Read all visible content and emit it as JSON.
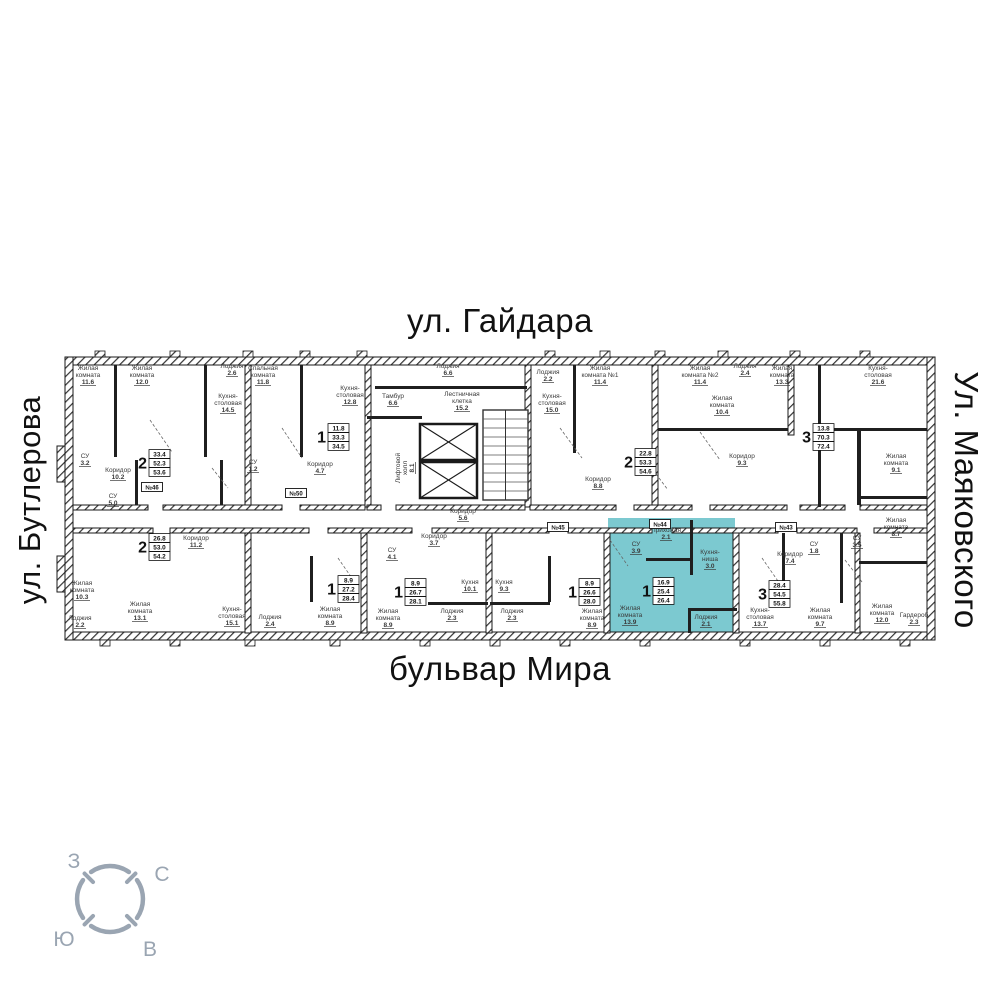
{
  "streets": {
    "top": "ул. Гайдара",
    "bottom": "бульвар Мира",
    "left": "ул. Бутлерова",
    "right": "Ул. Маяковского"
  },
  "colors": {
    "wall": "#1f1f1f",
    "hatch_line": "#333333",
    "highlight_fill": "#7cc9d0",
    "text": "#3a3a3a",
    "street_text": "#111111",
    "compass": "#9aa5b2"
  },
  "compass": {
    "west": "З",
    "north": "С",
    "south": "Ю",
    "east": "В"
  },
  "apartments": [
    {
      "id": "a1",
      "rooms": "2",
      "living": "33.4",
      "area": "52.3",
      "total": "53.6",
      "x": 148,
      "y": 463,
      "highlighted": false
    },
    {
      "id": "a2",
      "rooms": "1",
      "living": "11.8",
      "area": "33.3",
      "total": "34.5",
      "x": 327,
      "y": 437,
      "highlighted": false
    },
    {
      "id": "a3",
      "rooms": "2",
      "living": "22.8",
      "area": "53.3",
      "total": "54.6",
      "x": 634,
      "y": 462,
      "highlighted": false
    },
    {
      "id": "a4",
      "rooms": "3",
      "living": "13.8",
      "area": "70.3",
      "total": "72.4",
      "x": 812,
      "y": 437,
      "highlighted": false
    },
    {
      "id": "a5",
      "rooms": "2",
      "living": "26.8",
      "area": "53.0",
      "total": "54.2",
      "x": 148,
      "y": 547,
      "highlighted": false
    },
    {
      "id": "a6",
      "rooms": "1",
      "living": "8.9",
      "area": "27.2",
      "total": "28.4",
      "x": 337,
      "y": 589,
      "highlighted": false
    },
    {
      "id": "a7",
      "rooms": "1",
      "living": "8.9",
      "area": "26.7",
      "total": "28.1",
      "x": 404,
      "y": 592,
      "highlighted": false
    },
    {
      "id": "a8",
      "rooms": "1",
      "living": "8.9",
      "area": "26.6",
      "total": "28.0",
      "x": 578,
      "y": 592,
      "highlighted": false
    },
    {
      "id": "a9",
      "rooms": "1",
      "living": "16.9",
      "area": "25.4",
      "total": "26.4",
      "x": 652,
      "y": 591,
      "highlighted": true
    },
    {
      "id": "a10",
      "rooms": "3",
      "living": "28.4",
      "area": "54.5",
      "total": "55.8",
      "x": 768,
      "y": 594,
      "highlighted": false
    }
  ],
  "room_labels": [
    {
      "lines": [
        "Жилая",
        "комната"
      ],
      "area": "11.6",
      "x": 88,
      "y": 370
    },
    {
      "lines": [
        "Жилая",
        "комната"
      ],
      "area": "12.0",
      "x": 142,
      "y": 370
    },
    {
      "lines": [
        "Лоджия"
      ],
      "area": "2.6",
      "x": 232,
      "y": 368
    },
    {
      "lines": [
        "Кухня-",
        "столовая"
      ],
      "area": "14.5",
      "x": 228,
      "y": 398
    },
    {
      "lines": [
        "Спальная",
        "комната"
      ],
      "area": "11.8",
      "x": 263,
      "y": 370
    },
    {
      "lines": [
        "Кухня-",
        "столовая"
      ],
      "area": "12.8",
      "x": 350,
      "y": 390
    },
    {
      "lines": [
        "СУ"
      ],
      "area": "3.2",
      "x": 85,
      "y": 458
    },
    {
      "lines": [
        "Коридор"
      ],
      "area": "10.2",
      "x": 118,
      "y": 472
    },
    {
      "lines": [
        "СУ"
      ],
      "area": "1.2",
      "x": 253,
      "y": 464
    },
    {
      "lines": [
        "Коридор"
      ],
      "area": "4.7",
      "x": 320,
      "y": 466
    },
    {
      "lines": [
        "Лоджия"
      ],
      "area": "6.6",
      "x": 448,
      "y": 368
    },
    {
      "lines": [
        "Тамбур"
      ],
      "area": "6.6",
      "x": 393,
      "y": 398
    },
    {
      "lines": [
        "Лестничная",
        "клетка"
      ],
      "area": "15.2",
      "x": 462,
      "y": 396
    },
    {
      "lines": [
        "Лифтовой",
        "холл"
      ],
      "area": "8.1",
      "x": 400,
      "y": 468,
      "vertical": true
    },
    {
      "lines": [
        "Коридор"
      ],
      "area": "5.6",
      "x": 463,
      "y": 513
    },
    {
      "lines": [
        "Лоджия"
      ],
      "area": "2.2",
      "x": 548,
      "y": 374
    },
    {
      "lines": [
        "Кухня-",
        "столовая"
      ],
      "area": "15.0",
      "x": 552,
      "y": 398
    },
    {
      "lines": [
        "Жилая",
        "комната №1"
      ],
      "area": "11.4",
      "x": 600,
      "y": 370
    },
    {
      "lines": [
        "Жилая",
        "комната №2"
      ],
      "area": "11.4",
      "x": 700,
      "y": 370
    },
    {
      "lines": [
        "Коридор"
      ],
      "area": "8.8",
      "x": 598,
      "y": 481
    },
    {
      "lines": [
        "Лоджия"
      ],
      "area": "2.4",
      "x": 745,
      "y": 368
    },
    {
      "lines": [
        "Жилая",
        "комната"
      ],
      "area": "13.3",
      "x": 782,
      "y": 370
    },
    {
      "lines": [
        "Кухня-",
        "столовая"
      ],
      "area": "21.6",
      "x": 878,
      "y": 370
    },
    {
      "lines": [
        "Жилая",
        "комната"
      ],
      "area": "10.4",
      "x": 722,
      "y": 400
    },
    {
      "lines": [
        "Коридор"
      ],
      "area": "9.3",
      "x": 742,
      "y": 458
    },
    {
      "lines": [
        "Жилая",
        "комната"
      ],
      "area": "9.1",
      "x": 896,
      "y": 458
    },
    {
      "lines": [
        "Жилая",
        "комната"
      ],
      "area": "8.7",
      "x": 896,
      "y": 522
    },
    {
      "lines": [
        "СУ"
      ],
      "area": "5.0",
      "x": 113,
      "y": 498
    },
    {
      "lines": [
        "Коридор"
      ],
      "area": "11.2",
      "x": 196,
      "y": 540
    },
    {
      "lines": [
        "Жилая",
        "комната"
      ],
      "area": "10.3",
      "x": 82,
      "y": 585
    },
    {
      "lines": [
        "Лоджия"
      ],
      "area": "2.2",
      "x": 80,
      "y": 620
    },
    {
      "lines": [
        "Жилая",
        "комната"
      ],
      "area": "13.1",
      "x": 140,
      "y": 606
    },
    {
      "lines": [
        "Кухня-",
        "столовая"
      ],
      "area": "15.1",
      "x": 232,
      "y": 611
    },
    {
      "lines": [
        "Лоджия"
      ],
      "area": "2.4",
      "x": 270,
      "y": 619
    },
    {
      "lines": [
        "Коридор"
      ],
      "area": "3.7",
      "x": 434,
      "y": 538
    },
    {
      "lines": [
        "Жилая",
        "комната"
      ],
      "area": "8.9",
      "x": 330,
      "y": 611
    },
    {
      "lines": [
        "Жилая",
        "комната"
      ],
      "area": "8.9",
      "x": 388,
      "y": 613
    },
    {
      "lines": [
        "Кухня"
      ],
      "area": "10.1",
      "x": 470,
      "y": 584
    },
    {
      "lines": [
        "Кухня"
      ],
      "area": "9.3",
      "x": 504,
      "y": 584
    },
    {
      "lines": [
        "Лоджия"
      ],
      "area": "2.3",
      "x": 452,
      "y": 613
    },
    {
      "lines": [
        "Лоджия"
      ],
      "area": "2.3",
      "x": 512,
      "y": 613
    },
    {
      "lines": [
        "СУ"
      ],
      "area": "4.1",
      "x": 392,
      "y": 552
    },
    {
      "lines": [
        "Жилая",
        "комната"
      ],
      "area": "8.9",
      "x": 592,
      "y": 613
    },
    {
      "lines": [
        "Прихожая"
      ],
      "area": "2.1",
      "x": 666,
      "y": 532
    },
    {
      "lines": [
        "СУ"
      ],
      "area": "3.9",
      "x": 636,
      "y": 546
    },
    {
      "lines": [
        "Кухня-",
        "ниша"
      ],
      "area": "3.0",
      "x": 710,
      "y": 554
    },
    {
      "lines": [
        "Жилая",
        "комната"
      ],
      "area": "13.9",
      "x": 630,
      "y": 610
    },
    {
      "lines": [
        "Лоджия"
      ],
      "area": "2.1",
      "x": 706,
      "y": 619
    },
    {
      "lines": [
        "Кухня-",
        "столовая"
      ],
      "area": "13.7",
      "x": 760,
      "y": 612
    },
    {
      "lines": [
        "Жилая",
        "комната"
      ],
      "area": "9.7",
      "x": 820,
      "y": 612
    },
    {
      "lines": [
        "Жилая",
        "комната"
      ],
      "area": "12.0",
      "x": 882,
      "y": 608
    },
    {
      "lines": [
        "Гардероб"
      ],
      "area": "2.3",
      "x": 914,
      "y": 617
    },
    {
      "lines": [
        "Коридор"
      ],
      "area": "7.4",
      "x": 790,
      "y": 556
    },
    {
      "lines": [
        "СУ"
      ],
      "area": "1.8",
      "x": 814,
      "y": 546
    },
    {
      "lines": [
        "СУ"
      ],
      "area": "3.5",
      "x": 857,
      "y": 540
    }
  ],
  "door_tags": [
    {
      "text": "№46",
      "x": 152,
      "y": 487
    },
    {
      "text": "№50",
      "x": 296,
      "y": 493
    },
    {
      "text": "№45",
      "x": 558,
      "y": 527
    },
    {
      "text": "№44",
      "x": 660,
      "y": 524
    },
    {
      "text": "№43",
      "x": 786,
      "y": 527
    }
  ]
}
